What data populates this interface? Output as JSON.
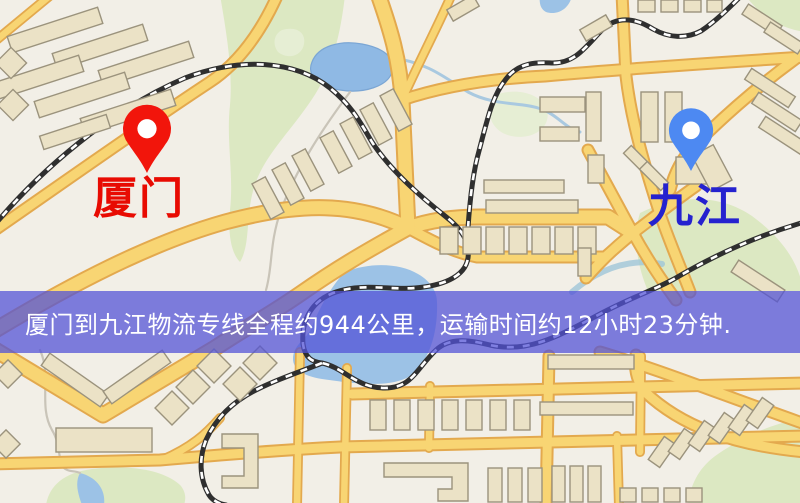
{
  "map": {
    "origin": {
      "label": "厦门",
      "marker": "red-pin",
      "marker_color": "#f2150b",
      "label_color": "#e80b02"
    },
    "destination": {
      "label": "九江",
      "marker": "blue-pin",
      "marker_color": "#4d89f2",
      "label_color": "#2522cf"
    }
  },
  "banner": {
    "text": "厦门到九江物流专线全程约944公里，运输时间约12小时23分钟.",
    "background_color": "rgba(82,82,214,0.74)",
    "text_color": "#ffffff"
  },
  "route": {
    "distance_km": 944,
    "duration_hours": 12,
    "duration_minutes": 23
  },
  "palette": {
    "background": "#f2efe7",
    "road_fill": "#f8d573",
    "road_casing": "#e3a94e",
    "building": "#ebe2c6",
    "green_area": "#dce8c2",
    "water": "#9cc2e6",
    "railway": "#2f2f2f"
  }
}
